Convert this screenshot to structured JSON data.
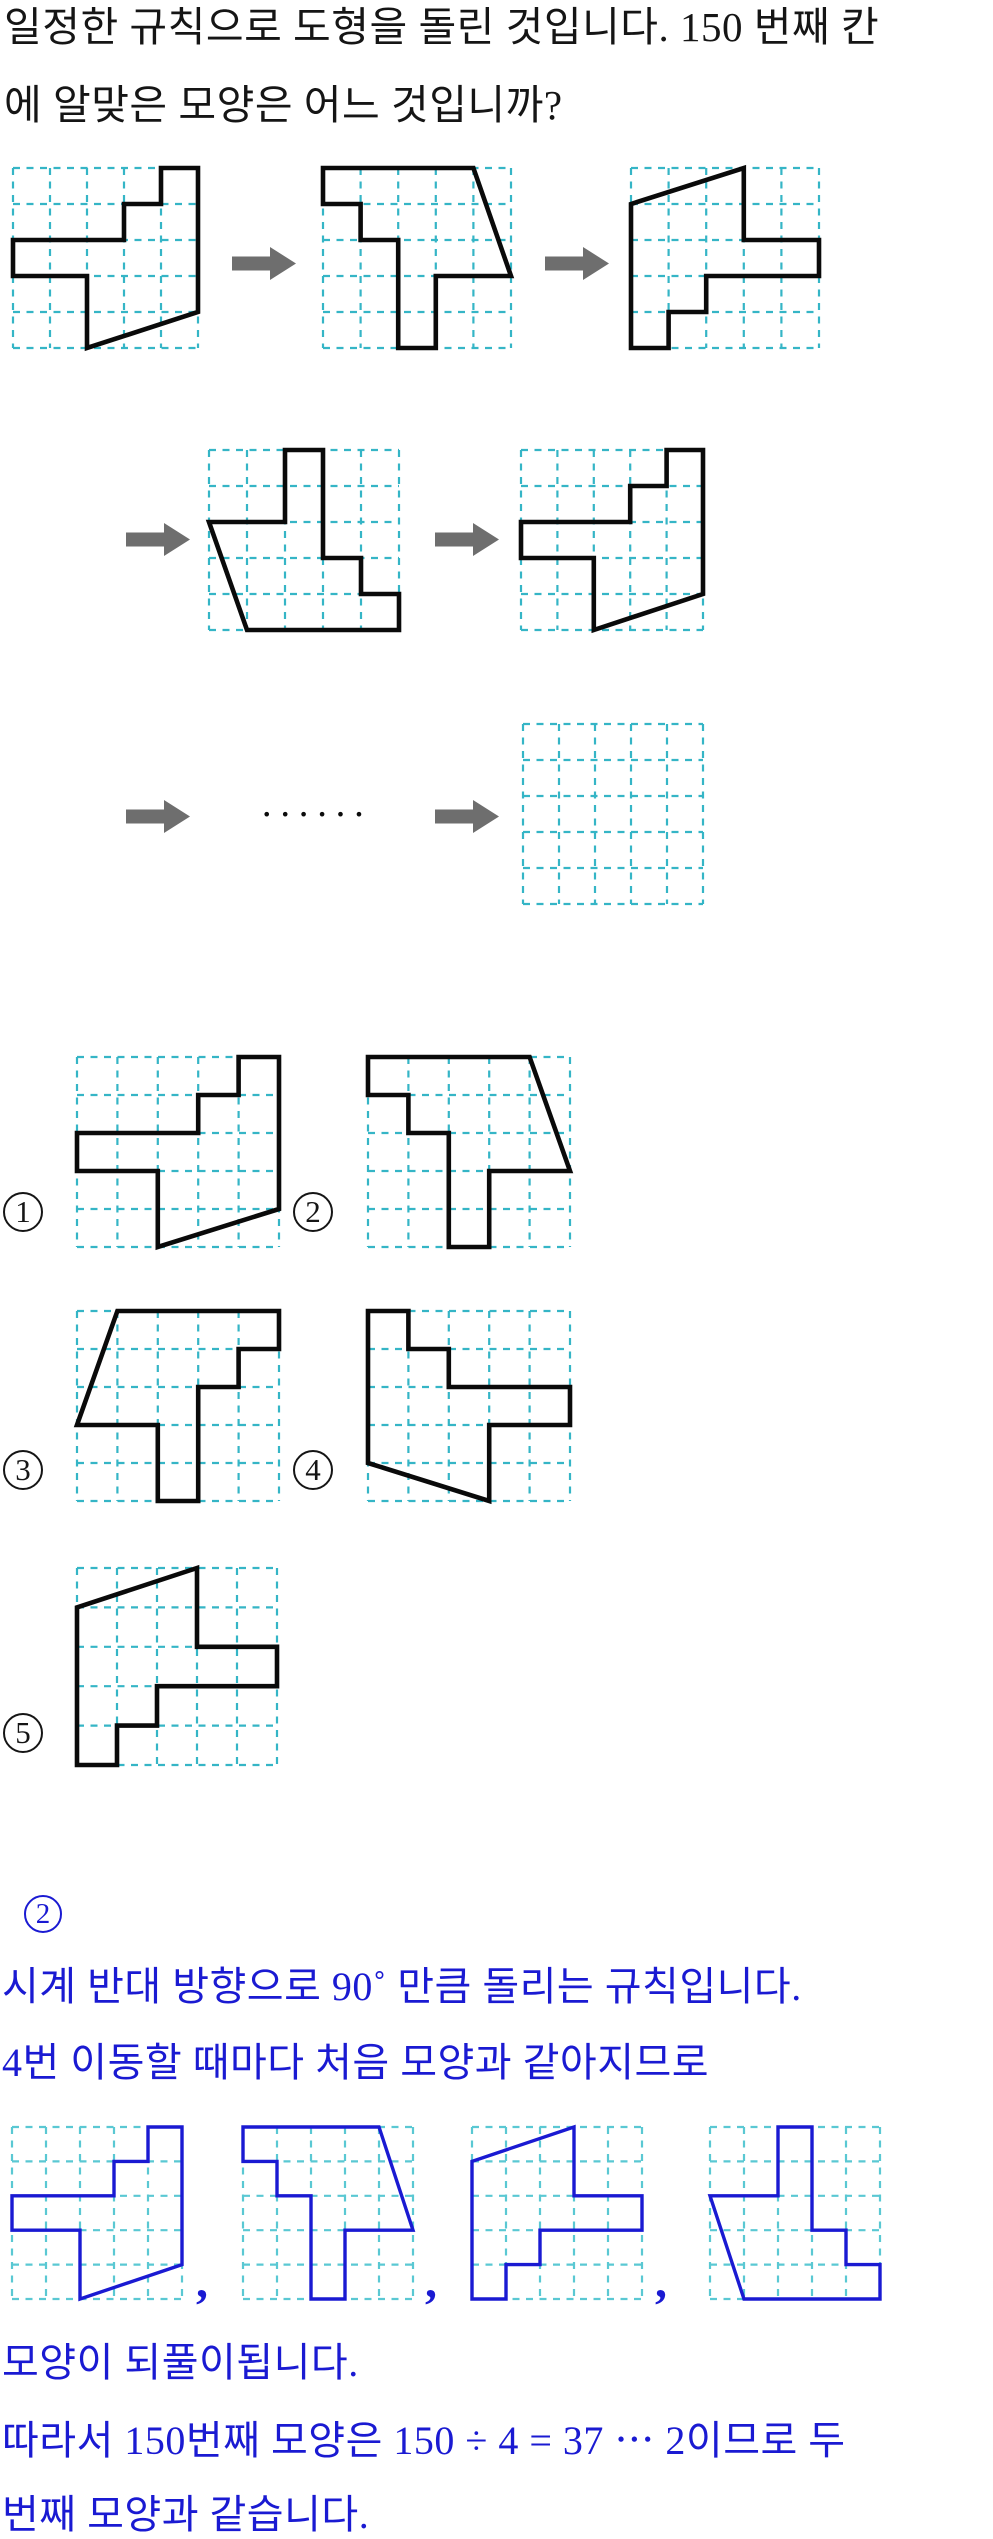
{
  "title": {
    "line1": "일정한 규칙으로 도형을 돌린 것입니다. 150 번째 칸",
    "line2": "에 알맞은 모양은 어느 것입니까?"
  },
  "colors": {
    "ink": "#151515",
    "shape_stroke": "#0a0a0a",
    "grid_teal": "#35b5c6",
    "grid_teal_light": "#5ac8d3",
    "arrow_gray": "#6e6e6e",
    "answer_blue": "#1a1ad2"
  },
  "shapes": {
    "shape1": [
      [
        4,
        0
      ],
      [
        5,
        0
      ],
      [
        5,
        4
      ],
      [
        2,
        5
      ],
      [
        2,
        3
      ],
      [
        0,
        3
      ],
      [
        0,
        2
      ],
      [
        3,
        2
      ],
      [
        3,
        1
      ],
      [
        4,
        1
      ]
    ],
    "shape2": [
      [
        0,
        0
      ],
      [
        4,
        0
      ],
      [
        5,
        3
      ],
      [
        3,
        3
      ],
      [
        3,
        5
      ],
      [
        2,
        5
      ],
      [
        2,
        2
      ],
      [
        1,
        2
      ],
      [
        1,
        1
      ],
      [
        0,
        1
      ]
    ],
    "shape3": [
      [
        3,
        0
      ],
      [
        3,
        2
      ],
      [
        5,
        2
      ],
      [
        5,
        3
      ],
      [
        2,
        3
      ],
      [
        2,
        4
      ],
      [
        1,
        4
      ],
      [
        1,
        5
      ],
      [
        0,
        5
      ],
      [
        0,
        1
      ]
    ],
    "shape4": [
      [
        2,
        0
      ],
      [
        3,
        0
      ],
      [
        3,
        3
      ],
      [
        4,
        3
      ],
      [
        4,
        4
      ],
      [
        5,
        4
      ],
      [
        5,
        5
      ],
      [
        1,
        5
      ],
      [
        0,
        2
      ],
      [
        2,
        2
      ]
    ],
    "option3": [
      [
        1,
        0
      ],
      [
        5,
        0
      ],
      [
        5,
        1
      ],
      [
        4,
        1
      ],
      [
        4,
        2
      ],
      [
        3,
        2
      ],
      [
        3,
        5
      ],
      [
        2,
        5
      ],
      [
        2,
        3
      ],
      [
        0,
        3
      ]
    ],
    "option4": [
      [
        0,
        0
      ],
      [
        1,
        0
      ],
      [
        1,
        1
      ],
      [
        2,
        1
      ],
      [
        2,
        2
      ],
      [
        5,
        2
      ],
      [
        5,
        3
      ],
      [
        3,
        3
      ],
      [
        3,
        5
      ],
      [
        0,
        4
      ]
    ]
  },
  "sequence": {
    "ellipsis": "••••••"
  },
  "options": [
    {
      "label": "1"
    },
    {
      "label": "2"
    },
    {
      "label": "3"
    },
    {
      "label": "4"
    },
    {
      "label": "5"
    }
  ],
  "answer": {
    "number": "2",
    "line1": "시계 반대 방향으로 90˚ 만큼 돌리는 규칙입니다.",
    "line2": "4번 이동할 때마다 처음 모양과 같아지므로",
    "comma": ",",
    "line3": "모양이 되풀이됩니다.",
    "line4": "따라서 150번째 모양은 150 ÷ 4 = 37 ⋯ 2이므로 두",
    "line5": "번째 모양과 같습니다."
  }
}
